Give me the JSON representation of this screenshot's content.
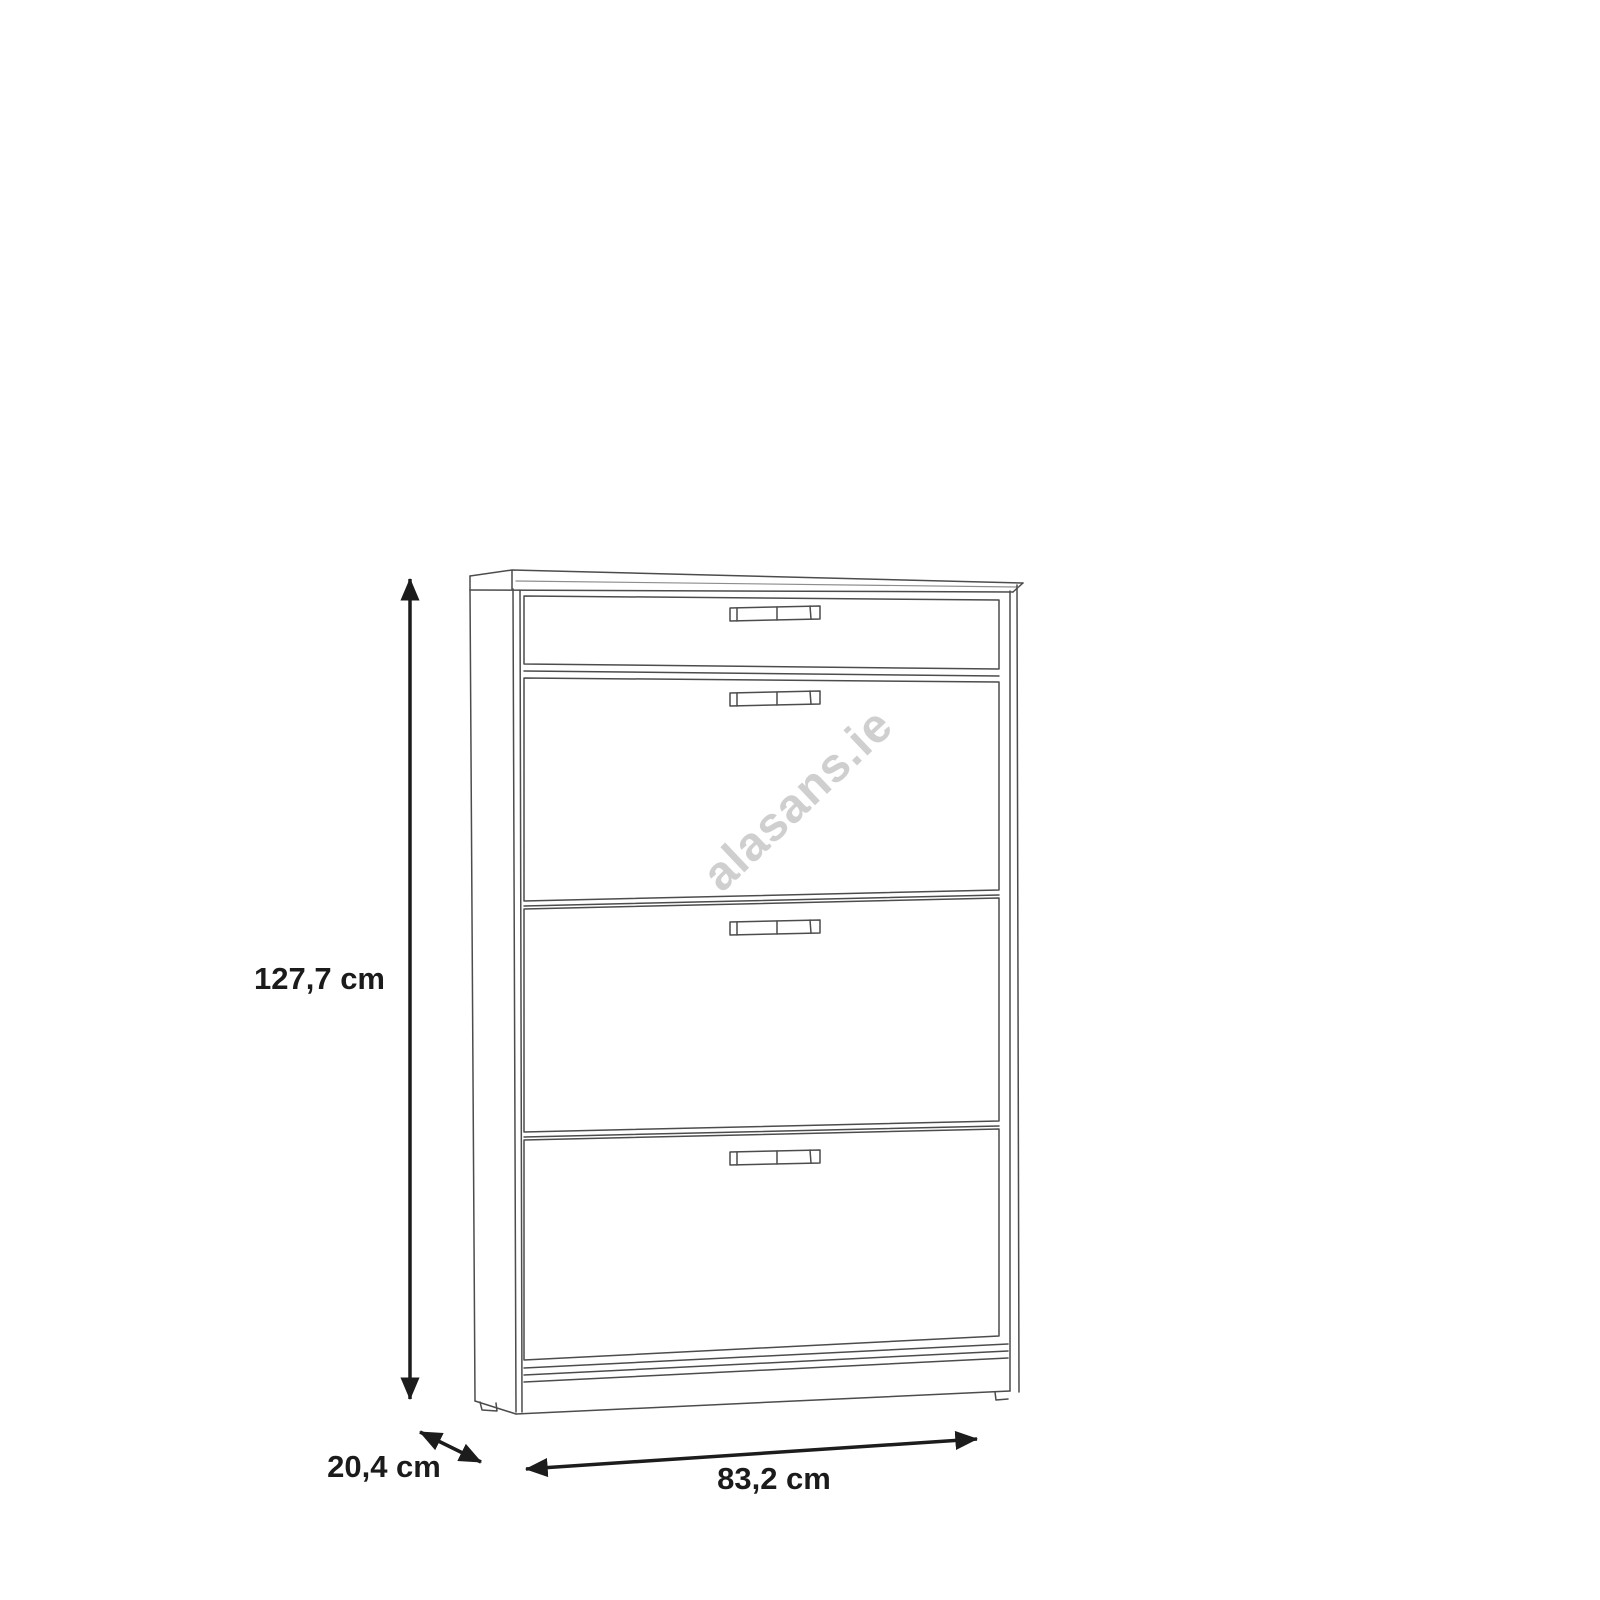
{
  "page": {
    "background_color": "#ffffff",
    "description": "Product dimension line drawing of a shoe cabinet with one top drawer and three tilting flap doors"
  },
  "diagram": {
    "type": "furniture-dimension-diagram",
    "subject": "shoe-cabinet-1-drawer-3-flaps",
    "line_color": "#4c4c4c",
    "label_color": "#1b1b1b",
    "watermark": {
      "text": "alasans.ie",
      "color": "#c4c4c4",
      "rotation_deg": -43.5
    },
    "dimensions": {
      "height": {
        "label": "127,7 cm",
        "value_cm": 127.7,
        "orientation": "vertical"
      },
      "depth": {
        "label": "20,4 cm",
        "value_cm": 20.4,
        "orientation": "diagonal"
      },
      "width": {
        "label": "83,2 cm",
        "value_cm": 83.2,
        "orientation": "horizontal"
      }
    },
    "parts": {
      "drawer_count": 1,
      "flap_count": 3,
      "handle_count": 4
    }
  }
}
